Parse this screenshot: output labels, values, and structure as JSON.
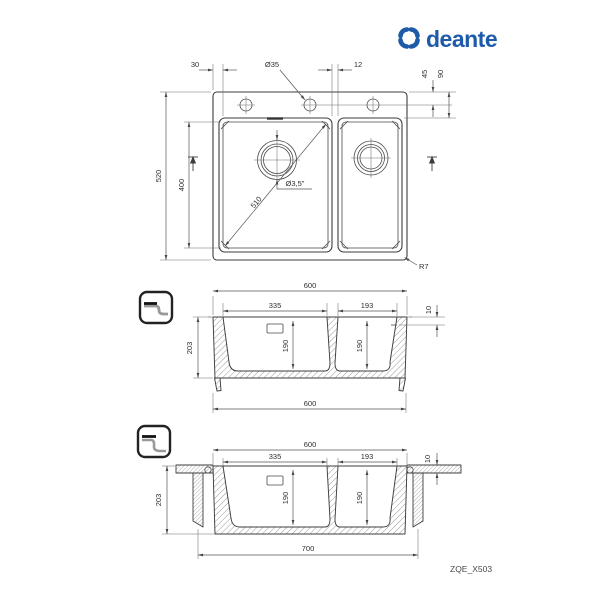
{
  "brand": {
    "name": "deante",
    "color": "#1d5ba9"
  },
  "product_code": "ZQE_X503",
  "plan_view": {
    "rim_left": "30",
    "faucet_hole_diameter": "Ø35",
    "hole_offset": "12",
    "edge_to_holes": "45",
    "edge_to_bowl": "90",
    "overall_depth": "520",
    "bowl_depth": "400",
    "bowl_diagonal": "510",
    "drain_diameter": "Ø3,5\"",
    "corner_radius": "R7"
  },
  "section_view": {
    "overall_width": "600",
    "main_bowl_width": "335",
    "second_bowl_width": "193",
    "rim_height": "10",
    "overall_height": "203",
    "main_bowl_depth": "190",
    "second_bowl_depth": "190",
    "base_width": "600"
  },
  "mounted_view": {
    "overall_width": "600",
    "main_bowl_width": "335",
    "second_bowl_width": "193",
    "countertop_thickness": "10",
    "overall_height": "203",
    "main_bowl_depth": "190",
    "second_bowl_depth": "190",
    "cutout_width": "700"
  }
}
